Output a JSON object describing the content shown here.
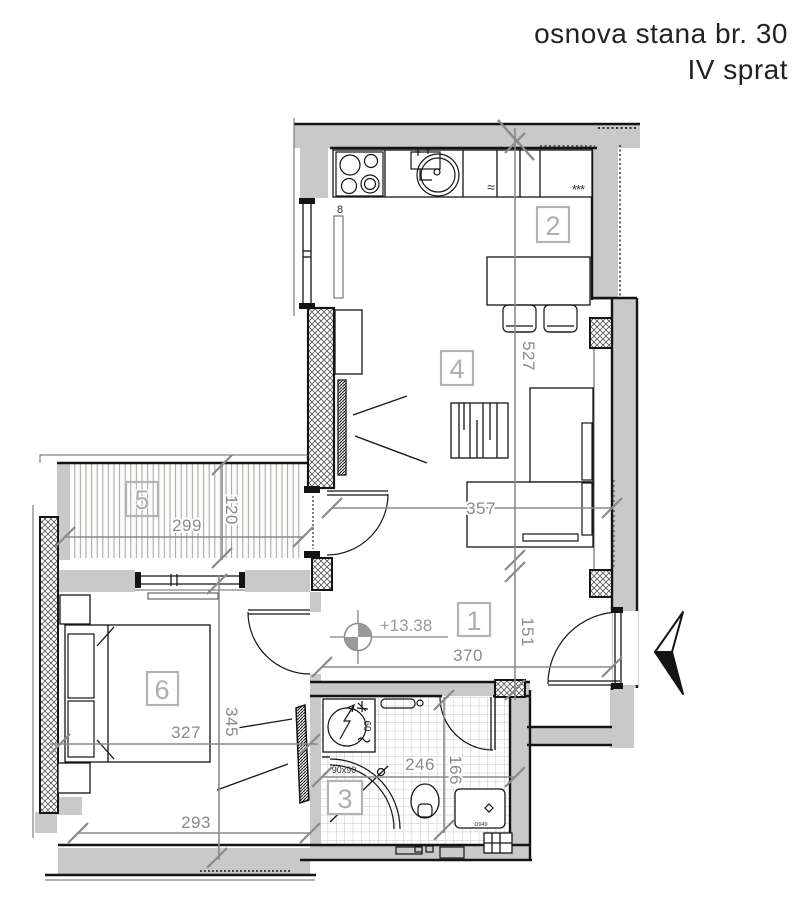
{
  "header": {
    "title": "osnova stana br. 30",
    "floor": "IV sprat"
  },
  "plan": {
    "room_labels": {
      "r1": "1",
      "r2": "2",
      "r3": "3",
      "r4": "4",
      "r5": "5",
      "r6": "6"
    },
    "dimensions_cm": {
      "kitchen_living_depth": "527",
      "living_width": "357",
      "terrace_width": "299",
      "terrace_depth": "120",
      "hall_width": "370",
      "hall_depth": "151",
      "bedroom_width": "327",
      "bedroom_depth": "345",
      "bedroom_width_lower": "293",
      "bathroom_width": "246",
      "bathroom_depth": "166"
    },
    "level": {
      "elevation": "+13.38"
    },
    "fixture_labels": {
      "kitchen_radiator": "8",
      "washing_machine": "60",
      "shower": "90x90",
      "bathroom_sink": "D949",
      "freezer": "***",
      "dishwasher": "≈"
    },
    "colors": {
      "wall_fill": "#c9c9c9",
      "dimension": "#8a8a8a",
      "room_label": "#aeaeae",
      "line": "#141414"
    }
  }
}
